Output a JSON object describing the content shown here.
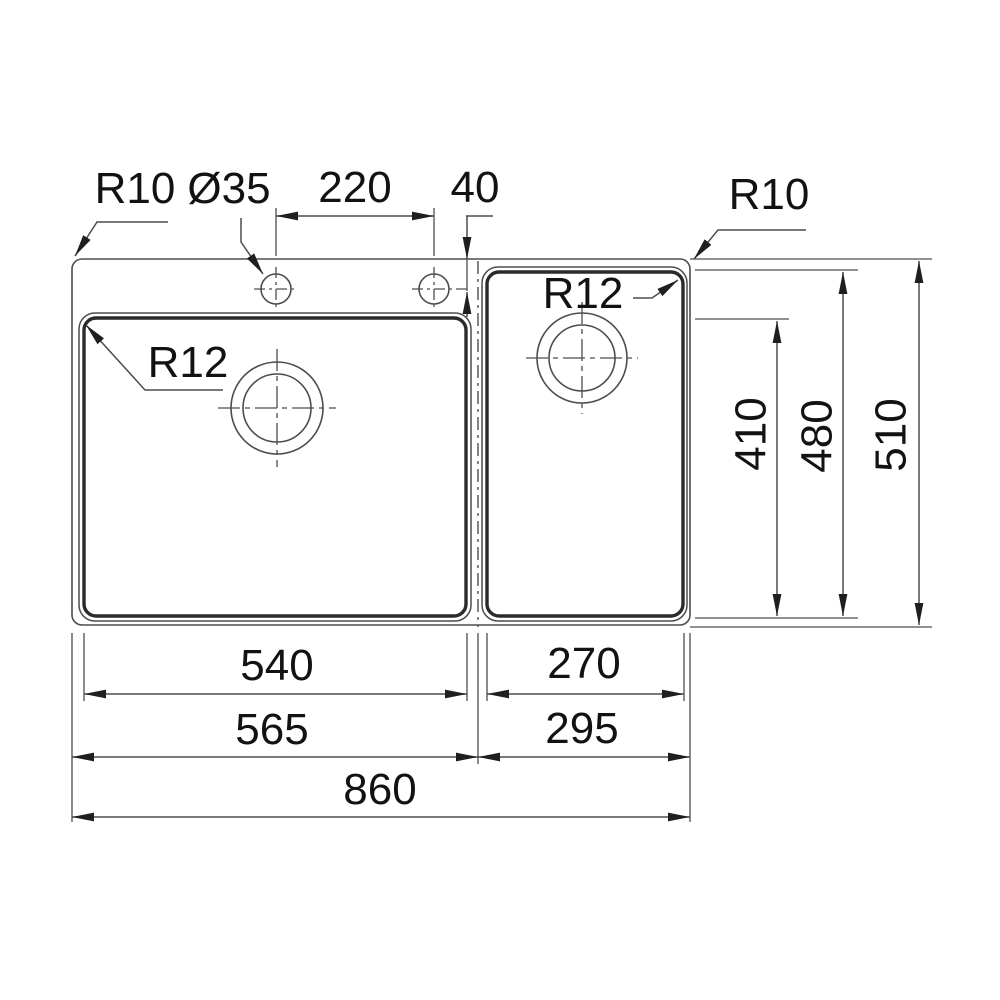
{
  "drawing": {
    "annotations": {
      "top_left_corner_radius": "R10",
      "faucet_hole_diameter": "Ø35",
      "faucet_hole_spacing": "220",
      "faucet_hole_rear_offset": "40",
      "top_right_corner_radius": "R10",
      "left_bowl_corner_radius": "R12",
      "right_bowl_corner_radius": "R12"
    },
    "dimensions_bottom": {
      "left_bowl_width": "540",
      "right_bowl_width": "270",
      "left_section_width": "565",
      "right_section_width": "295",
      "overall_width": "860"
    },
    "dimensions_right": {
      "bowl_depth": "410",
      "right_bowl_depth": "480",
      "overall_depth": "510"
    },
    "colors": {
      "background": "#ffffff",
      "thin_line": "#4d4d4d",
      "thick_line": "#2a2a2a",
      "arrow": "#1f1f1f",
      "text": "#121212"
    }
  }
}
